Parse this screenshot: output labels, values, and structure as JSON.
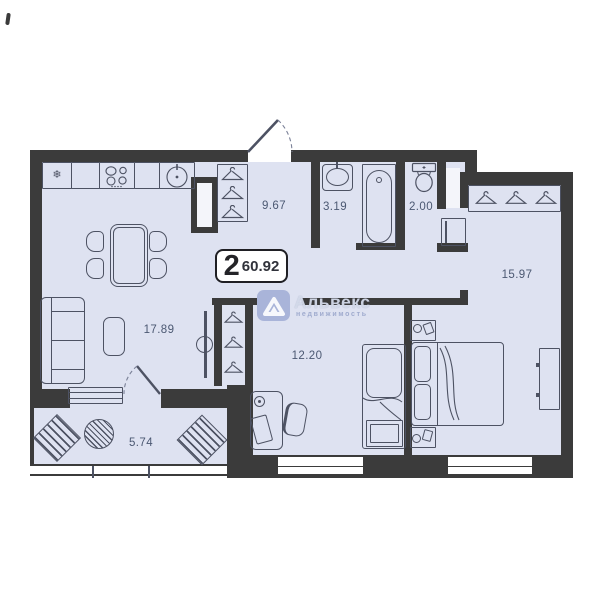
{
  "badge": {
    "rooms": "2",
    "area": "60.92"
  },
  "rooms": [
    {
      "id": "living",
      "area": "17.89"
    },
    {
      "id": "hallway",
      "area": "9.67"
    },
    {
      "id": "bathroom",
      "area": "3.19"
    },
    {
      "id": "wc",
      "area": "2.00"
    },
    {
      "id": "bedroom",
      "area": "15.97"
    },
    {
      "id": "room",
      "area": "12.20"
    },
    {
      "id": "balcony",
      "area": "5.74"
    }
  ],
  "watermark": {
    "brand": "Альвекс",
    "tagline": "недвижимость"
  },
  "icons": {
    "fridge": "❄"
  },
  "colors": {
    "floor": "#dee2f1",
    "wall": "#3b3b3b",
    "line": "#4d5263",
    "label": "#4b5872",
    "logo_blue": "#7d8ec4"
  }
}
